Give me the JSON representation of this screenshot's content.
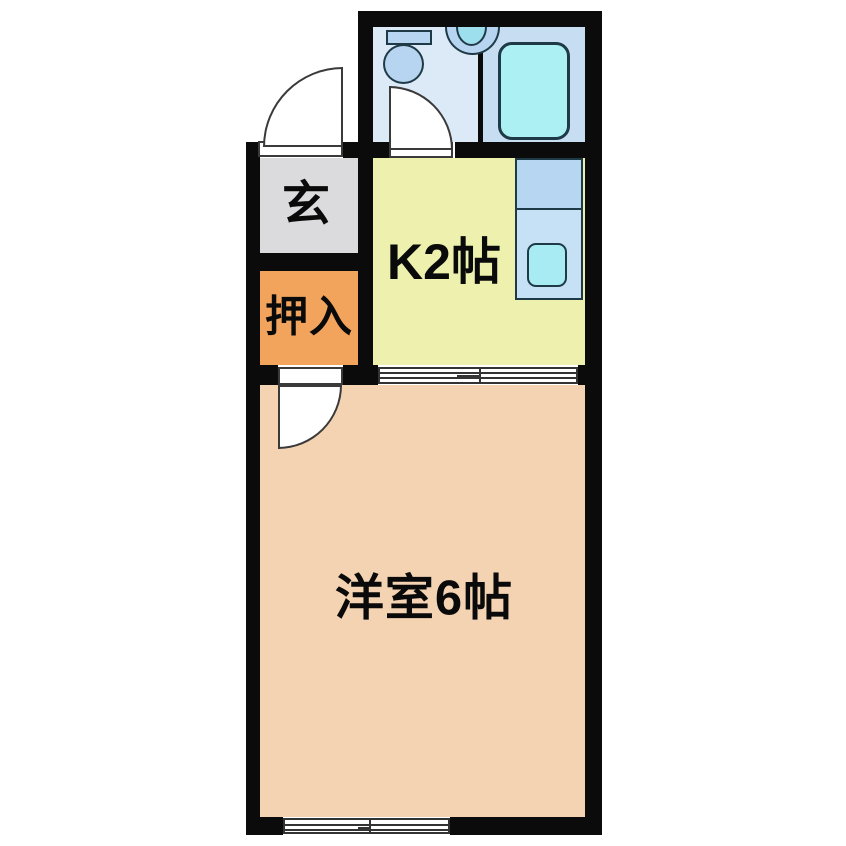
{
  "floor_plan": {
    "rooms": {
      "genkan": {
        "label": "玄",
        "color": "#dbdbdd"
      },
      "oshiire": {
        "label": "押入",
        "color": "#f2a45c"
      },
      "kitchen": {
        "label": "K2帖",
        "color": "#eef1ad"
      },
      "western_room": {
        "label": "洋室6帖",
        "color": "#f4d3b3"
      },
      "bathroom_toilet_area": {
        "color": "#dce9f7"
      },
      "bathroom_bath_area": {
        "color": "#c6ddf2"
      }
    },
    "fixtures": {
      "toilet": {
        "icon": "toilet-icon",
        "color": "#b7d4f1"
      },
      "washbasin": {
        "icon": "washbasin-icon",
        "color": "#b7d4f1",
        "bowl_color": "#9edfed"
      },
      "bathtub": {
        "icon": "bathtub-icon",
        "color": "#adf0f3"
      },
      "kitchen_counter": {
        "icon": "kitchen-counter-icon",
        "color": "#c6e0f5"
      },
      "kitchen_sink": {
        "icon": "kitchen-sink-icon",
        "color": "#a8ebf3"
      }
    },
    "openings": {
      "entrance_door": "hinged-door",
      "bathroom_door": "hinged-door",
      "western_room_door": "hinged-door",
      "kitchen_sliding_door": "sliding-door",
      "window": "sliding-window"
    },
    "wall_color": "#0b0b0b",
    "background_color": "#ffffff"
  }
}
